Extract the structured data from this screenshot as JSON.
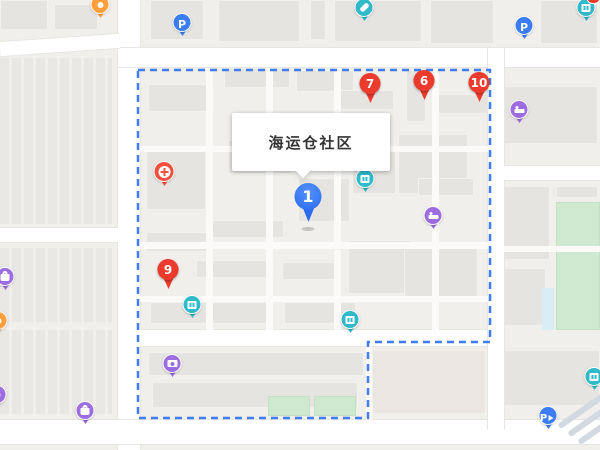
{
  "map": {
    "info_window": {
      "title": "海运仓社区"
    },
    "colors": {
      "boundary_blue": "#3f7df2",
      "pin_red": "#ec3a2c",
      "pin_blue": "#2a6cf0",
      "poi_teal": "#2fb9c9",
      "poi_purple": "#9d6ce0",
      "poi_orange": "#ff9f3c",
      "poi_blue": "#3b7cf3",
      "clinic_red": "#ef5140",
      "school_green": "#cfe9d1"
    },
    "street_labels": [
      {
        "text": "海运仓胡同",
        "x": 244,
        "y": 50
      },
      {
        "text": "海运仓胡同",
        "x": 546,
        "y": 49
      },
      {
        "text": "东直门南小街",
        "x": 119,
        "y": 82,
        "cls": "v"
      },
      {
        "text": "东直门南小街",
        "x": 119,
        "y": 252,
        "cls": "v"
      },
      {
        "text": "十二条",
        "x": 2,
        "y": 228
      },
      {
        "text": "北门仓胡同",
        "x": 203,
        "y": 333
      },
      {
        "text": "东四十条",
        "x": 218,
        "y": 427
      },
      {
        "text": "东四十条",
        "x": 548,
        "y": 436
      },
      {
        "text": "东颂年胡同",
        "x": 547,
        "y": 160
      },
      {
        "text": "海运仓社区",
        "x": 270,
        "y": 235,
        "cls": "area"
      }
    ],
    "building_labels": [
      {
        "text": "12号楼",
        "x": 233,
        "y": 76
      },
      {
        "text": "13号楼",
        "x": 185,
        "y": 109
      },
      {
        "text": "8号楼",
        "x": 346,
        "y": 97
      },
      {
        "text": "1号楼",
        "x": 405,
        "y": 98
      },
      {
        "text": "6号楼",
        "x": 463,
        "y": 102
      },
      {
        "text": "18号楼",
        "x": 143,
        "y": 211
      },
      {
        "text": "7号楼",
        "x": 214,
        "y": 224
      },
      {
        "text": "号楼",
        "x": 305,
        "y": 202
      },
      {
        "text": "11号楼",
        "x": 215,
        "y": 266
      },
      {
        "text": "9号楼",
        "x": 277,
        "y": 275
      },
      {
        "text": "1号楼",
        "x": 434,
        "y": 186
      },
      {
        "text": "2号楼",
        "x": 497,
        "y": 268
      },
      {
        "text": "3号楼",
        "x": 468,
        "y": 296
      },
      {
        "text": "6号楼",
        "x": 241,
        "y": 356
      }
    ],
    "poi_labels": [
      {
        "text": "一碗面重庆小面",
        "x": 60,
        "y": 18
      },
      {
        "text": "gcp药房",
        "x": 343,
        "y": 21
      },
      {
        "text": "瀚海海运仓",
        "x": 545,
        "y": 19
      },
      {
        "text": "北京京达",
        "x": 177,
        "y": 155
      },
      {
        "text": "口腔诊所",
        "x": 177,
        "y": 172
      },
      {
        "text": "海运仓",
        "x": 349,
        "y": 195
      },
      {
        "text": "北京海运仓",
        "x": 404,
        "y": 236
      },
      {
        "text": "家庭住宿",
        "x": 411,
        "y": 253
      },
      {
        "text": "中青记者",
        "x": 534,
        "y": 100
      },
      {
        "text": "之家饭店",
        "x": 534,
        "y": 117
      },
      {
        "text": "万果汇果园",
        "x": 18,
        "y": 277
      },
      {
        "text": "餐厅",
        "x": 0,
        "y": 336
      },
      {
        "text": "北门仓胡同",
        "x": 205,
        "y": 297
      },
      {
        "text": "11号楼-5单元",
        "x": 205,
        "y": 314
      },
      {
        "text": "北门仓",
        "x": 333,
        "y": 336
      },
      {
        "text": "恒祥美图片社",
        "x": 135,
        "y": 384
      },
      {
        "text": "佛缘玉石店",
        "x": 56,
        "y": 430
      },
      {
        "text": "外贸",
        "x": 4,
        "y": 419
      },
      {
        "text": "挂帽",
        "x": 0,
        "y": 432
      },
      {
        "text": "北京一商",
        "x": 532,
        "y": 359
      },
      {
        "text": "集团公司",
        "x": 532,
        "y": 377
      },
      {
        "text": "史家小学分",
        "x": 527,
        "y": 241,
        "cls": "teal"
      },
      {
        "text": "首都国医名师馆",
        "x": 341,
        "y": 376,
        "cls": "pink"
      }
    ],
    "markers": [
      {
        "name": "marker-pin-1",
        "kind": "pin-blue",
        "num": "1",
        "x": 308,
        "y": 183
      },
      {
        "name": "marker-pin-7",
        "kind": "pin-red",
        "num": "7",
        "x": 370,
        "y": 73
      },
      {
        "name": "marker-pin-6",
        "kind": "pin-red",
        "num": "6",
        "x": 424,
        "y": 70
      },
      {
        "name": "marker-pin-10",
        "kind": "pin-red",
        "num": "10",
        "x": 479,
        "y": 72
      },
      {
        "name": "marker-pin-9",
        "kind": "pin-red",
        "num": "9",
        "x": 168,
        "y": 259
      },
      {
        "name": "poi-noodle-shop",
        "kind": "poi",
        "color": "#ff9f3c",
        "icon": "food",
        "x": 100,
        "y": -4
      },
      {
        "name": "poi-parking-top-left",
        "kind": "poi",
        "color": "#3b7cf3",
        "icon": "p",
        "x": 182,
        "y": 14
      },
      {
        "name": "poi-gcp-pharmacy",
        "kind": "poi",
        "color": "#2fb9c9",
        "icon": "pill",
        "x": 364,
        "y": -1
      },
      {
        "name": "poi-hanhai-haiyuncang",
        "kind": "poi",
        "color": "#2fb9c9",
        "icon": "building",
        "badge": "1",
        "x": 586,
        "y": -1
      },
      {
        "name": "poi-parking-top-right",
        "kind": "poi",
        "color": "#3b7cf3",
        "icon": "p",
        "x": 524,
        "y": 17
      },
      {
        "name": "poi-dental-clinic",
        "kind": "poi",
        "color": "#ef5140",
        "icon": "cross",
        "x": 164,
        "y": 162,
        "cls": "lg"
      },
      {
        "name": "poi-haiyuncang",
        "kind": "poi",
        "color": "#2fb9c9",
        "icon": "building",
        "x": 365,
        "y": 170
      },
      {
        "name": "poi-haiyuncang-inn",
        "kind": "poi",
        "color": "#9d6ce0",
        "icon": "bed",
        "x": 433,
        "y": 207
      },
      {
        "name": "poi-zhongqing-hotel",
        "kind": "poi",
        "color": "#9d6ce0",
        "icon": "bed",
        "x": 519,
        "y": 101
      },
      {
        "name": "poi-wanguohui-fruit",
        "kind": "poi",
        "color": "#9d6ce0",
        "icon": "bag",
        "x": 5,
        "y": 268
      },
      {
        "name": "poi-restaurant",
        "kind": "poi",
        "color": "#ff9f3c",
        "icon": "dot",
        "x": -2,
        "y": 312
      },
      {
        "name": "poi-beimencang-unit",
        "kind": "poi",
        "color": "#2fb9c9",
        "icon": "building",
        "x": 192,
        "y": 296
      },
      {
        "name": "poi-beimencang",
        "kind": "poi",
        "color": "#2fb9c9",
        "icon": "building",
        "x": 350,
        "y": 311
      },
      {
        "name": "poi-hengxiangmei-photo",
        "kind": "poi",
        "color": "#9d6ce0",
        "icon": "camera",
        "x": 172,
        "y": 355
      },
      {
        "name": "poi-foyuan-jade",
        "kind": "poi",
        "color": "#9d6ce0",
        "icon": "bag",
        "x": 85,
        "y": 402
      },
      {
        "name": "poi-left-edge",
        "kind": "poi",
        "color": "#9d6ce0",
        "icon": "dot",
        "x": -3,
        "y": 386
      },
      {
        "name": "poi-parking-bottom-right",
        "kind": "poi",
        "color": "#3b7cf3",
        "icon": "parrow",
        "x": 548,
        "y": 407
      },
      {
        "name": "poi-yishang-company",
        "kind": "poi",
        "color": "#2fb9c9",
        "icon": "building",
        "x": 594,
        "y": 368
      }
    ],
    "arrows": [
      {
        "text": "←",
        "x": 318,
        "y": 424
      },
      {
        "text": "←",
        "x": 422,
        "y": 430
      }
    ]
  }
}
